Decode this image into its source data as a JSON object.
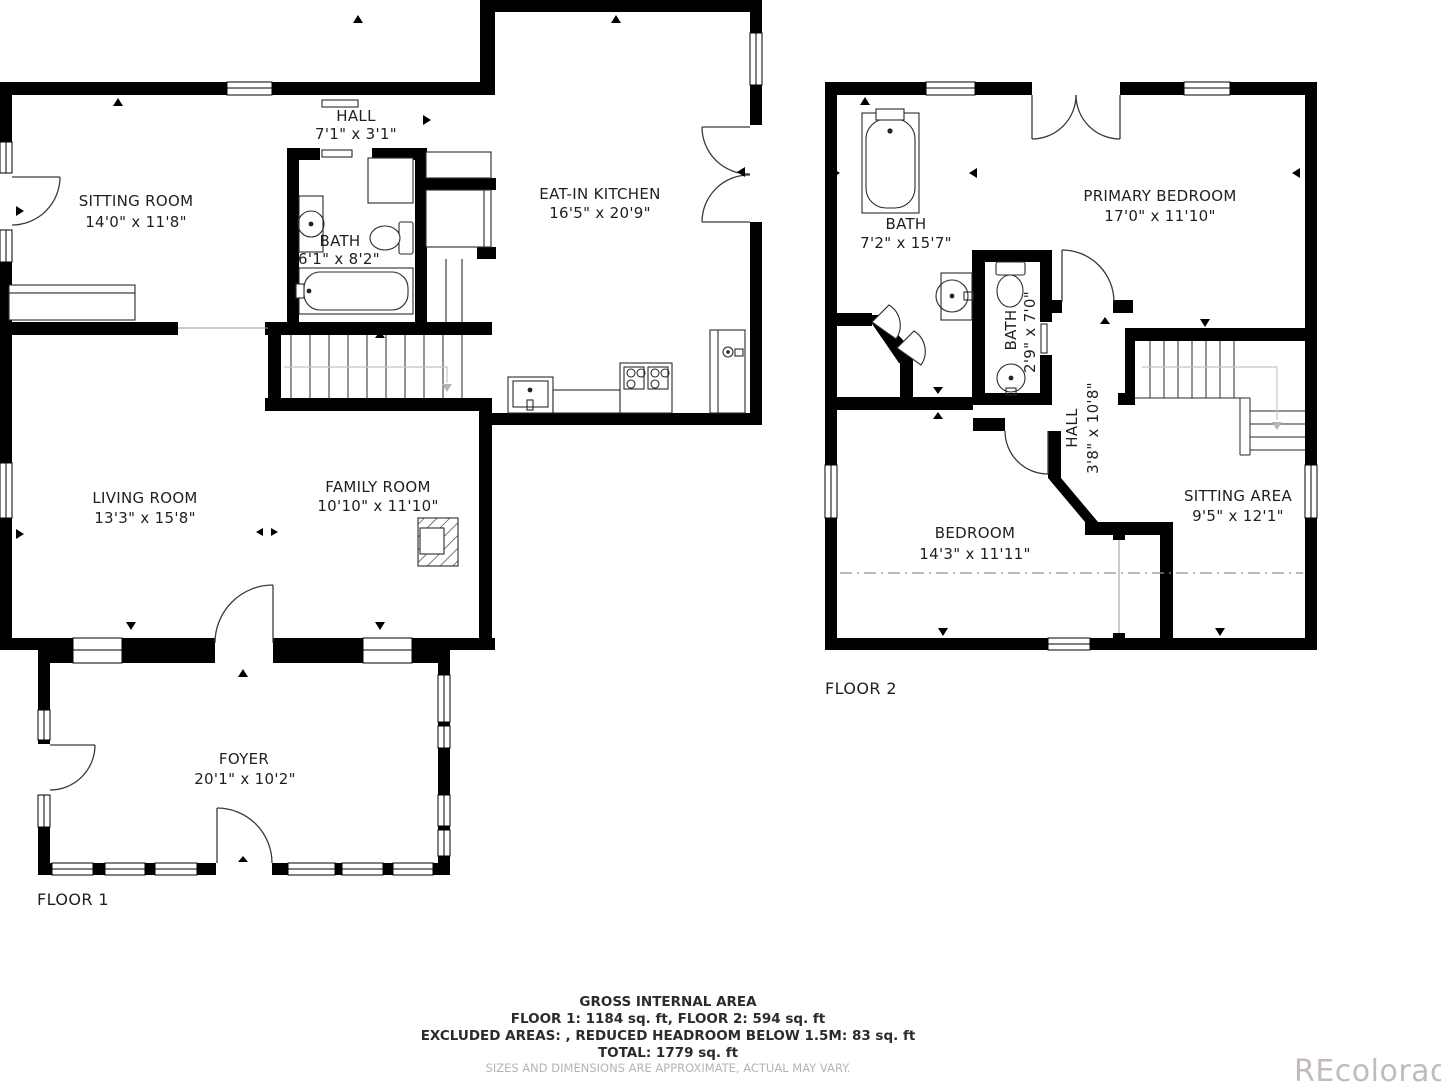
{
  "floor1": {
    "label": "FLOOR 1",
    "rooms": {
      "sitting": {
        "name": "SITTING ROOM",
        "dims": "14'0\" x 11'8\""
      },
      "hall": {
        "name": "HALL",
        "dims": "7'1\" x 3'1\""
      },
      "bath": {
        "name": "BATH",
        "dims": "6'1\" x 8'2\""
      },
      "kitchen": {
        "name": "EAT-IN KITCHEN",
        "dims": "16'5\" x 20'9\""
      },
      "living": {
        "name": "LIVING ROOM",
        "dims": "13'3\" x 15'8\""
      },
      "family": {
        "name": "FAMILY ROOM",
        "dims": "10'10\" x 11'10\""
      },
      "foyer": {
        "name": "FOYER",
        "dims": "20'1\" x 10'2\""
      }
    }
  },
  "floor2": {
    "label": "FLOOR 2",
    "rooms": {
      "bath": {
        "name": "BATH",
        "dims": "7'2\" x 15'7\""
      },
      "primary": {
        "name": "PRIMARY BEDROOM",
        "dims": "17'0\" x 11'10\""
      },
      "bath_small": {
        "name": "BATH",
        "dims": "2'9\" x 7'0\""
      },
      "hall": {
        "name": "HALL",
        "dims": "3'8\" x 10'8\""
      },
      "bedroom": {
        "name": "BEDROOM",
        "dims": "14'3\" x 11'11\""
      },
      "sitting_area": {
        "name": "SITTING AREA",
        "dims": "9'5\" x 12'1\""
      }
    }
  },
  "footer": {
    "title": "GROSS INTERNAL AREA",
    "floors": "FLOOR 1: 1184 sq. ft, FLOOR 2: 594 sq. ft",
    "excluded": "EXCLUDED AREAS: , REDUCED HEADROOM BELOW 1.5M: 83 sq. ft",
    "total": "TOTAL: 1779 sq. ft",
    "disclaimer": "SIZES AND DIMENSIONS ARE APPROXIMATE, ACTUAL MAY VARY."
  },
  "watermark": "REcolorado",
  "colors": {
    "wall": "#000000",
    "label": "#1f1f1f",
    "muted": "#b4b4b4",
    "watermark": "#c3bac1"
  }
}
